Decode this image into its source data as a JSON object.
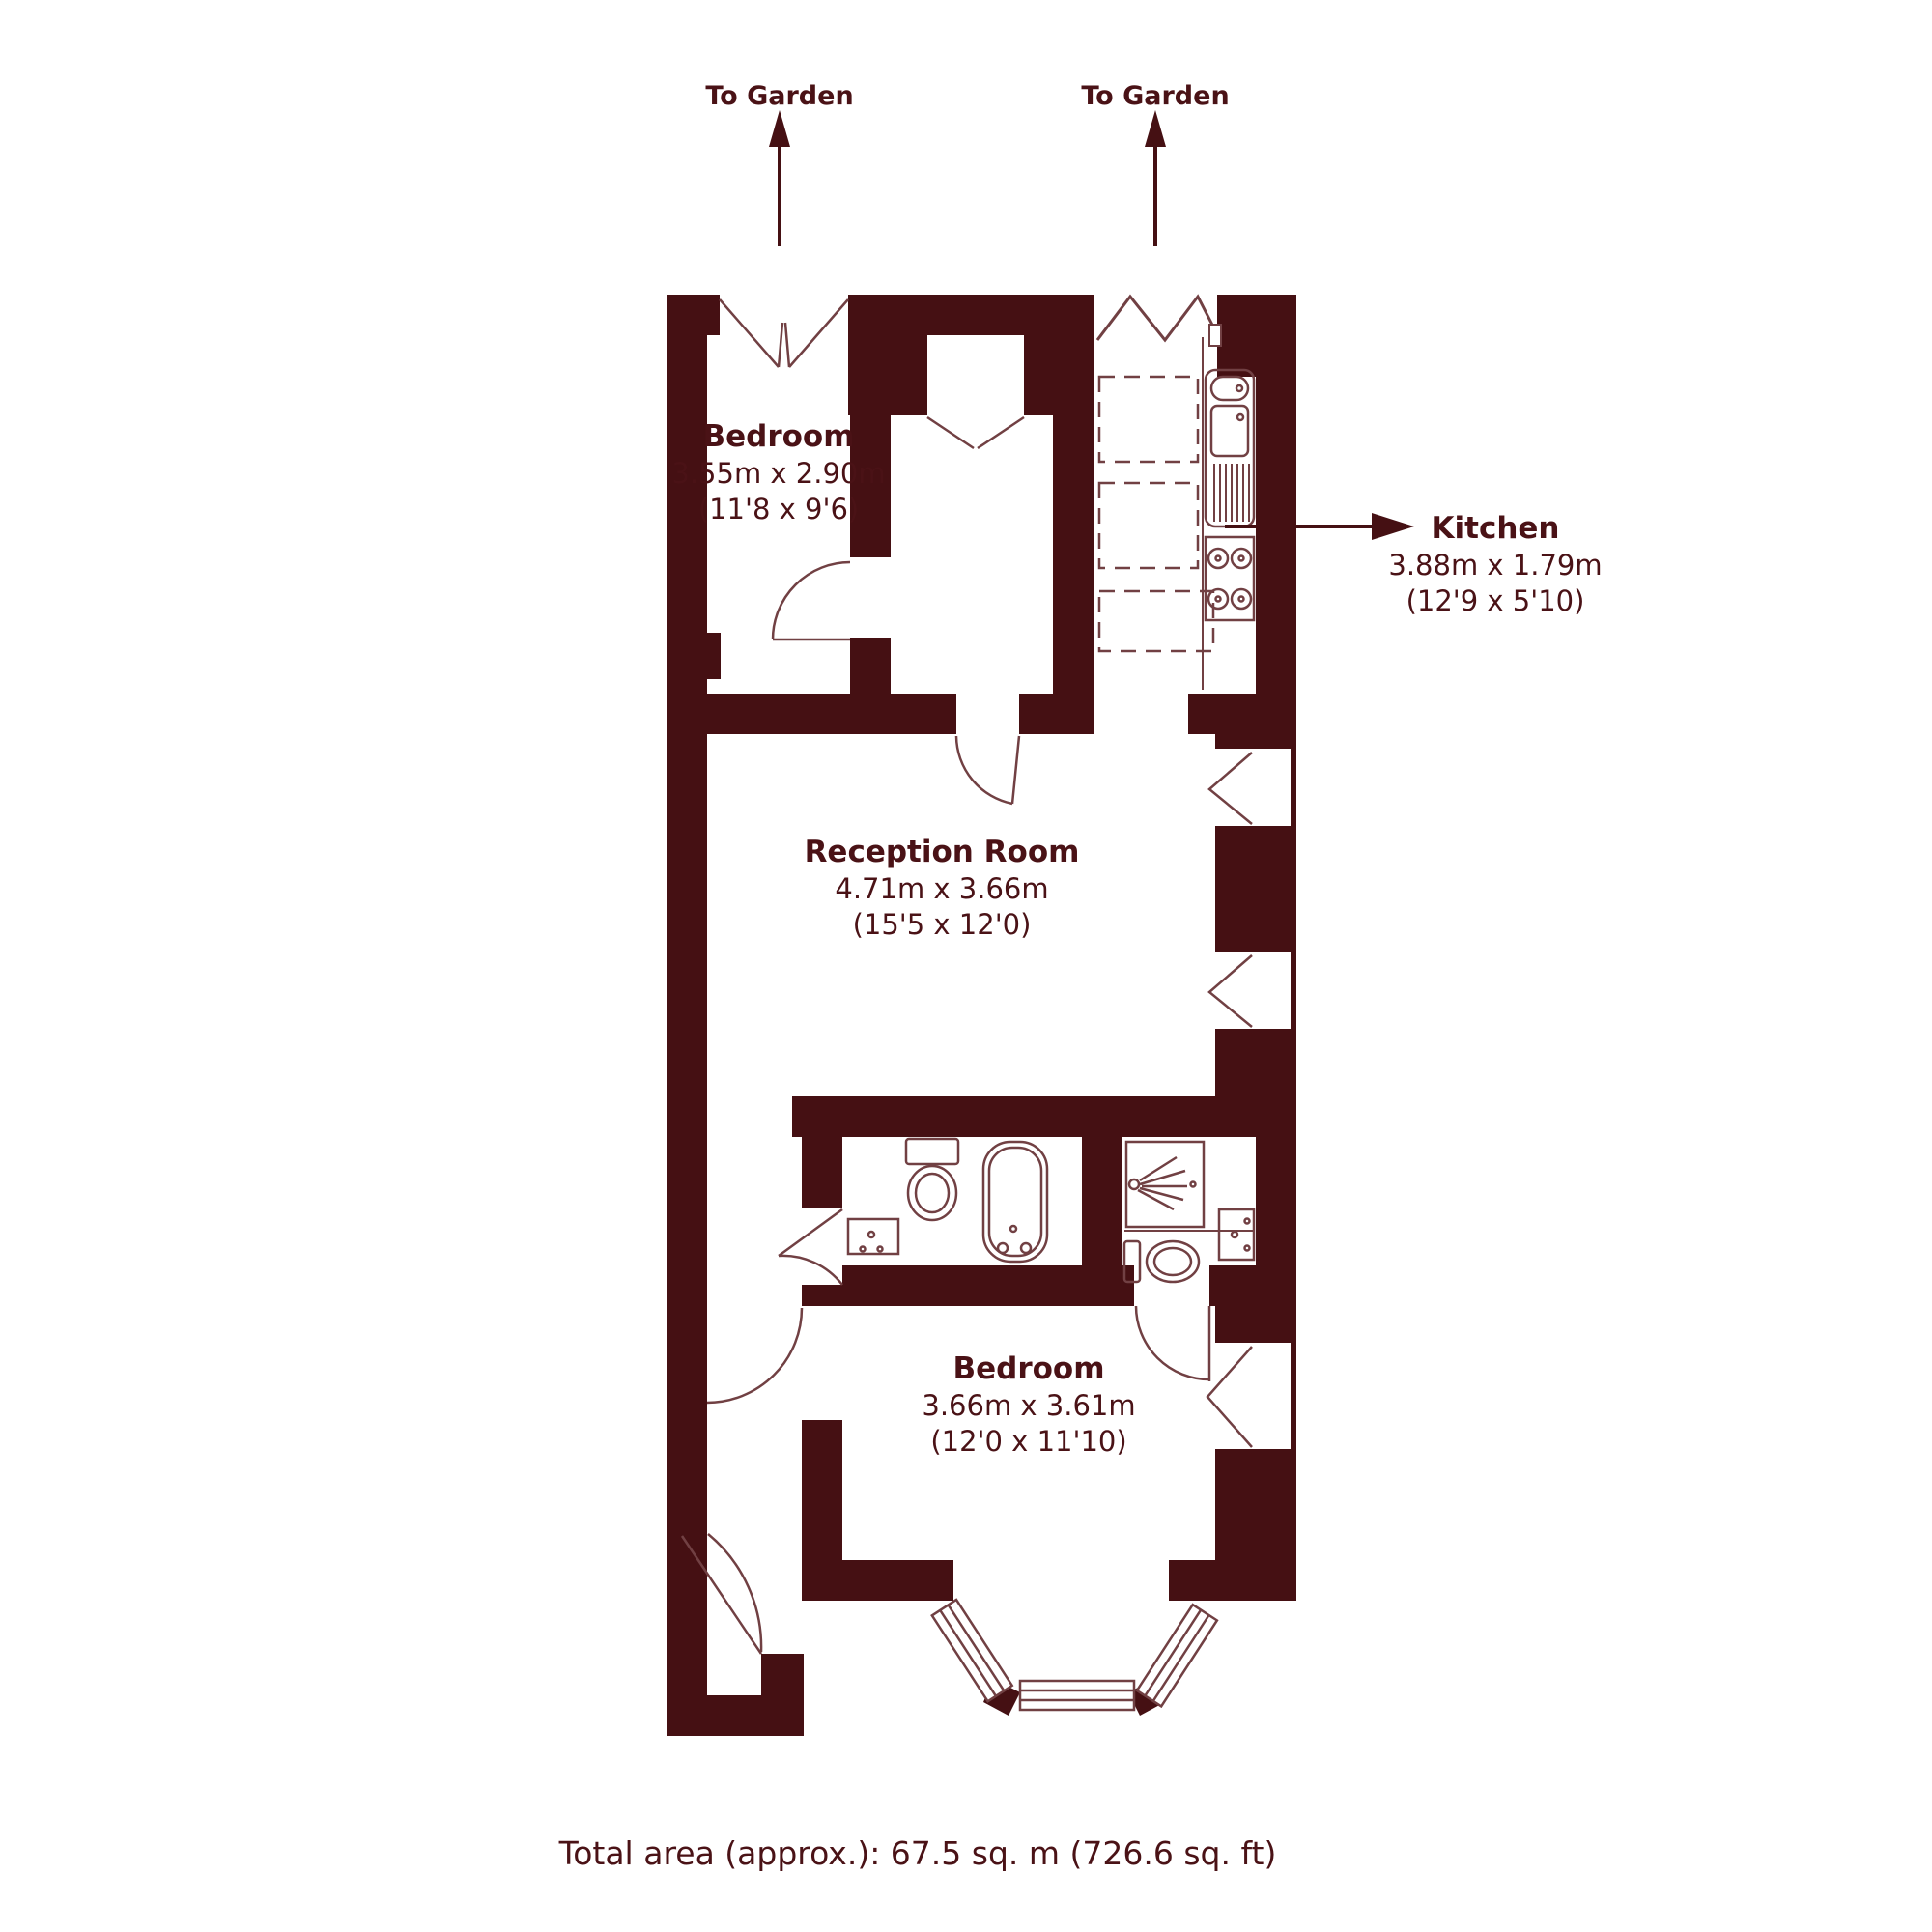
{
  "title": "Floor plan",
  "colors": {
    "background": "#ffffff",
    "wall": "#451013",
    "line": "#714043",
    "text": "#4a1216"
  },
  "garden_labels": [
    {
      "label": "To Garden"
    },
    {
      "label": "To Garden"
    }
  ],
  "rooms": [
    {
      "name": "Bedroom",
      "dimensions_metric": "3.55m x 2.90m",
      "dimensions_imperial": "(11'8 x 9'6)"
    },
    {
      "name": "Kitchen",
      "dimensions_metric": "3.88m x 1.79m",
      "dimensions_imperial": "(12'9 x 5'10)"
    },
    {
      "name": "Reception Room",
      "dimensions_metric": "4.71m x 3.66m",
      "dimensions_imperial": "(15'5 x 12'0)"
    },
    {
      "name": "Bedroom",
      "dimensions_metric": "3.66m x 3.61m",
      "dimensions_imperial": "(12'0 x 11'10)"
    }
  ],
  "fixtures": [
    "sink-icon",
    "hob-icon",
    "toilet-icon",
    "bath-icon",
    "basin-icon",
    "shower-icon",
    "toilet-icon",
    "basin-icon",
    "bay-window",
    "garden-arrow-icon",
    "kitchen-arrow-icon"
  ],
  "footer": {
    "total_area": "Total area (approx.): 67.5 sq. m (726.6 sq. ft)"
  }
}
